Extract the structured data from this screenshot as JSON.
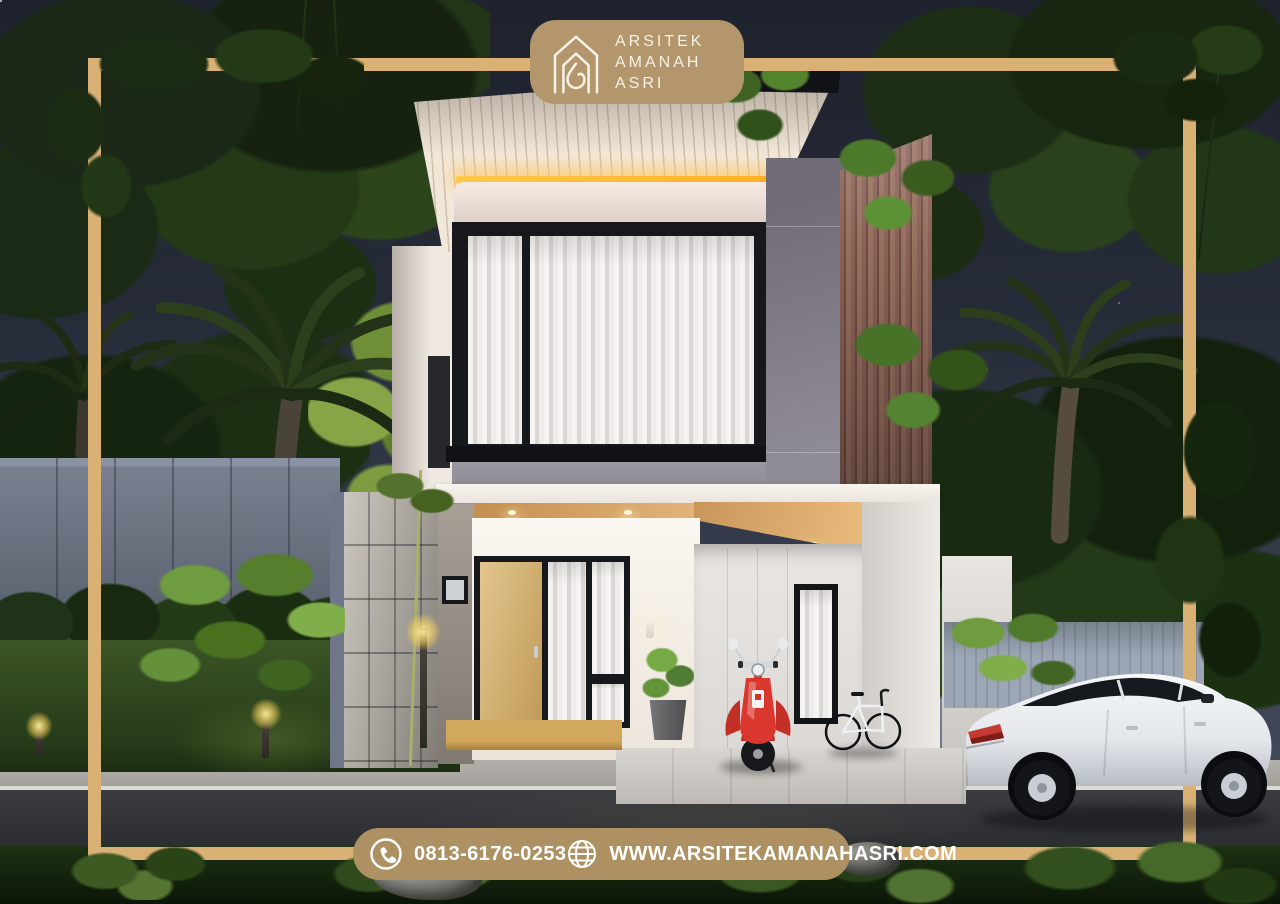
{
  "branding": {
    "name_lines": [
      "ARSITEK",
      "AMANAH",
      "ASRI"
    ],
    "logo_icon": "nested-house-outline-icon"
  },
  "contact_bar": {
    "phone": "0813-6176-0253",
    "website": "WWW.ARSITEKAMANAHASRI.COM",
    "phone_icon": "phone-icon",
    "globe_icon": "globe-icon"
  },
  "palette": {
    "gold_frame": "#D9B175",
    "badge_tan": "#B3966B",
    "bar_tan": "#AE9162",
    "brand_text": "#F7F1E6",
    "contact_text": "#FFFFFF",
    "sky_top": "#1E222D",
    "sky_bottom": "#4A4F5E",
    "roof_slats": "#F2E8D9",
    "led_strip": "#FFB938",
    "wood_accent_wall": "#8A6156",
    "gray_panel": "#8F8B95",
    "door_wood": "#D8B878",
    "scooter_red": "#D8352C",
    "car_white": "#EEF0F3",
    "foliage_dark": "#1B2817",
    "foliage_bright": "#6F9C3F",
    "lawn_green": "#3C5526",
    "road_asphalt": "#303236"
  },
  "scene": {
    "type": "3D architectural night render",
    "objects": [
      "two-story modern house",
      "slatted overhang roof with warm LED strip",
      "black-framed upper window with white curtains",
      "vertical wood slat accent wall",
      "gray panel facade",
      "wooden entry door with black-framed sidelights",
      "carport with wood ceiling and downlights",
      "red scooter",
      "bicycle",
      "white sedan car",
      "palm trees and tropical plants",
      "garden bollard lights",
      "concrete panel side wall",
      "lawn, hedge, sidewalk and asphalt road",
      "night sky with stars",
      "gold border frame"
    ]
  }
}
